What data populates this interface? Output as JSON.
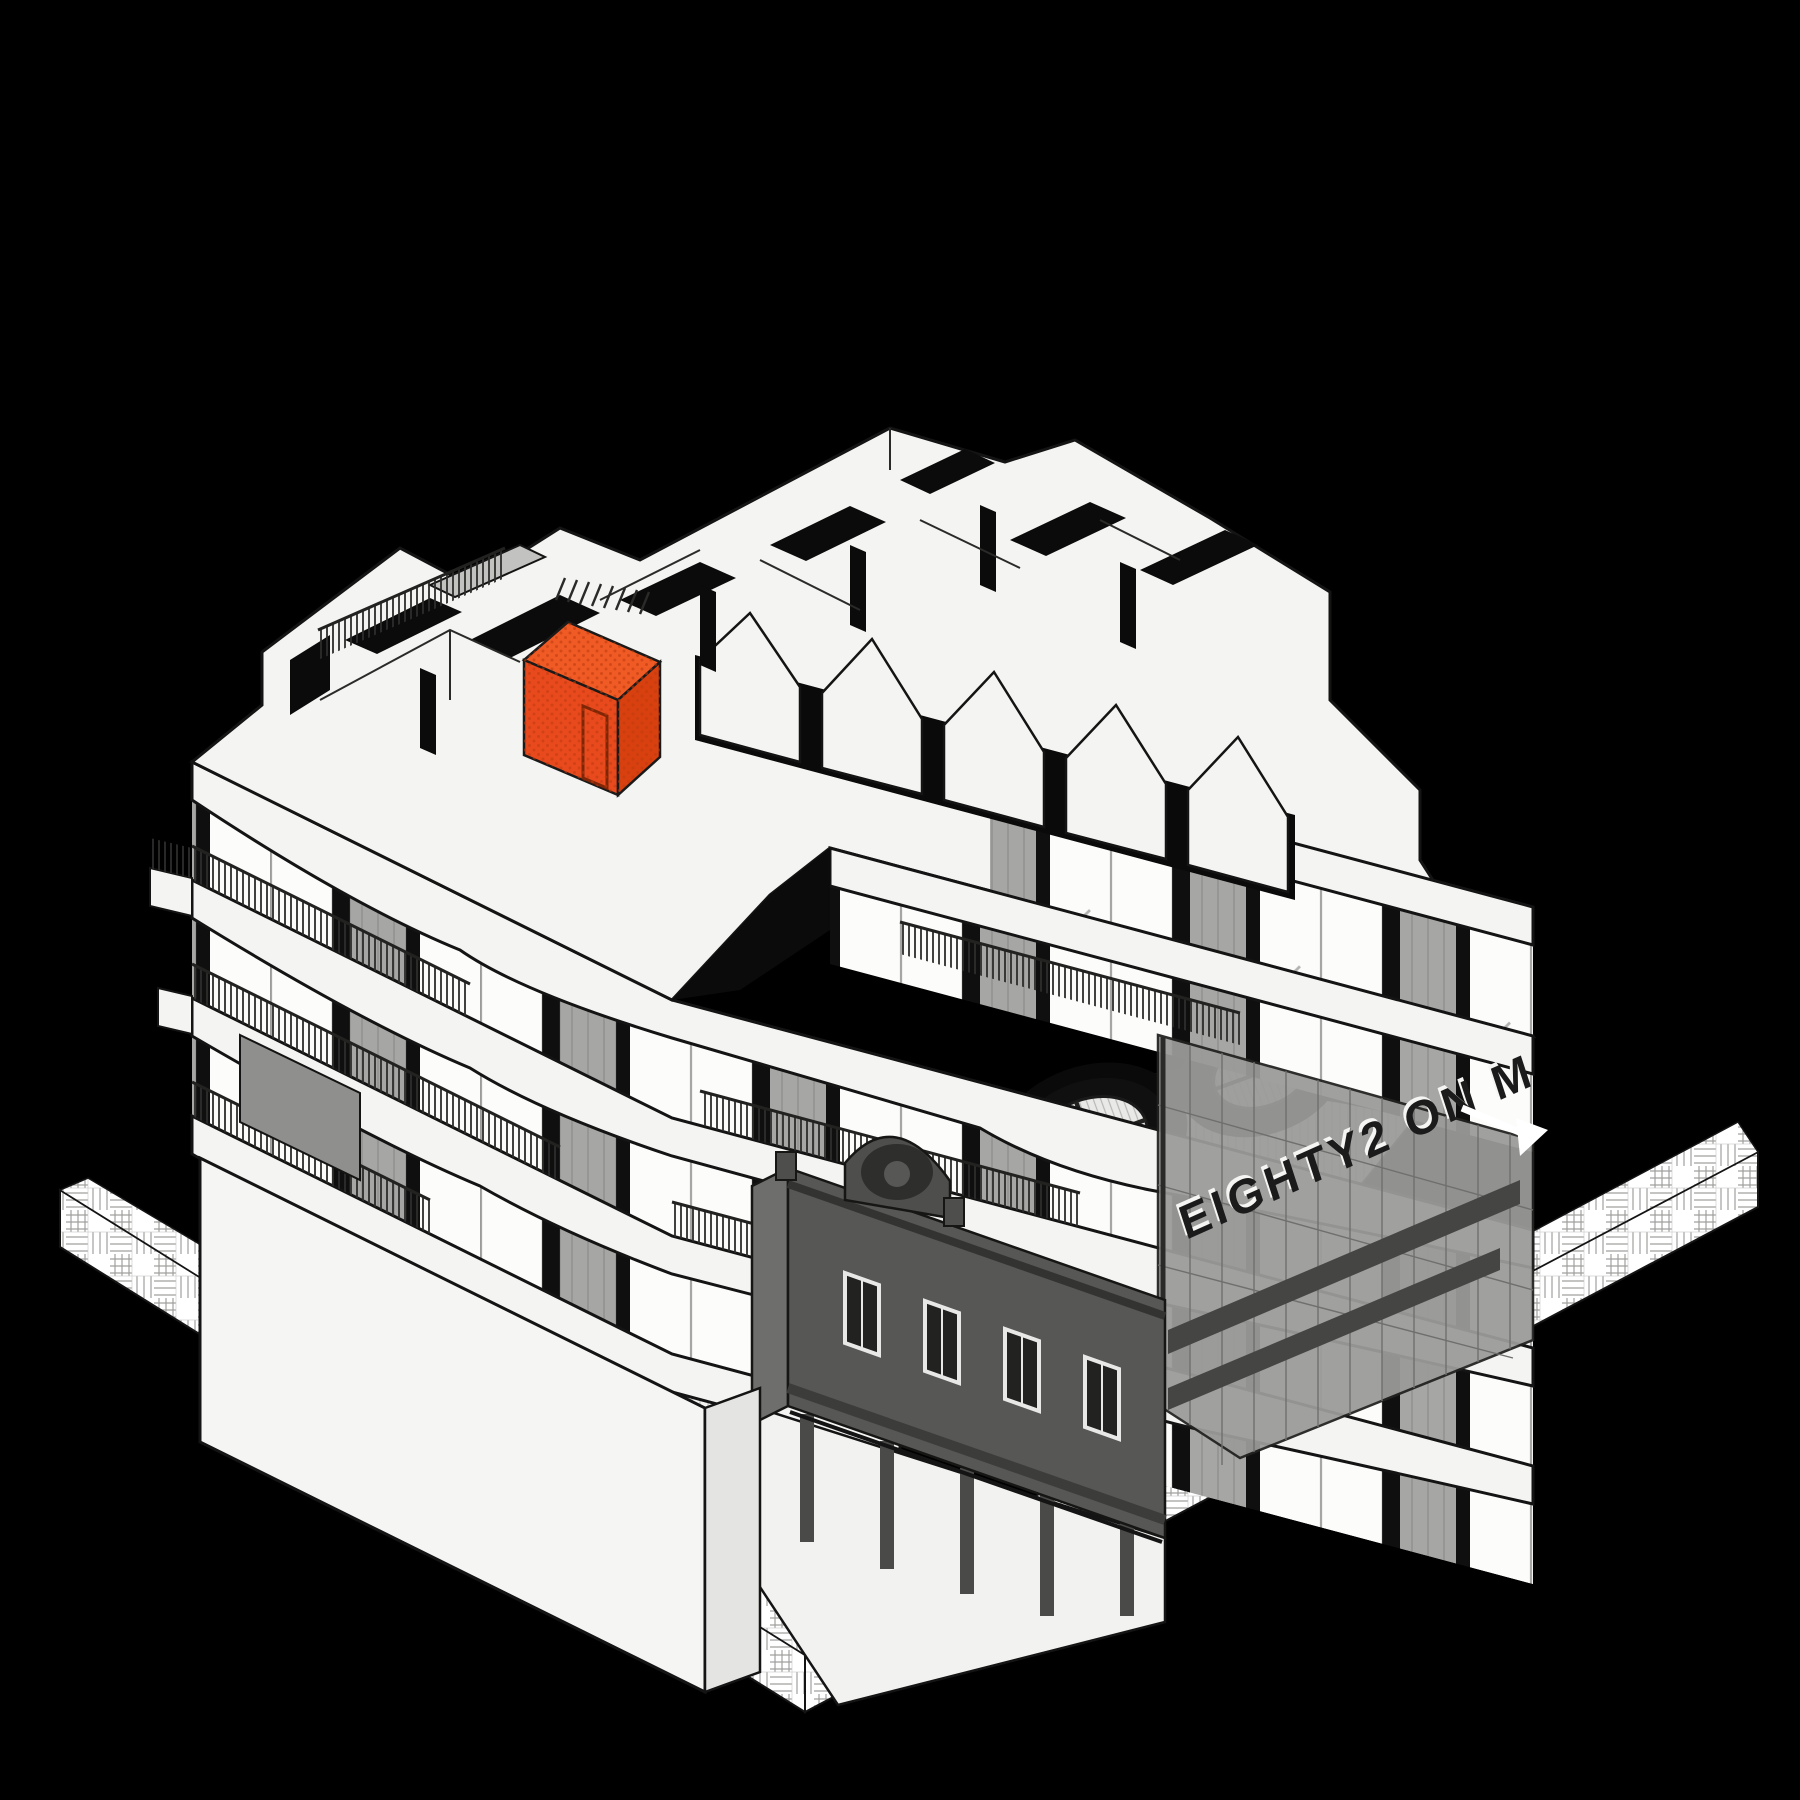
{
  "scene": {
    "background": "#000000",
    "description": "Axonometric cutaway rendering of apartment building with highlighted unit"
  },
  "sign": {
    "text": "EIGHTY2 ON M",
    "color": "#1b1b1b",
    "highlight_color": "#f5f5f3"
  },
  "highlight": {
    "label": "highlighted apartment",
    "color": "#E94A1D",
    "color_dark": "#D8400F",
    "color_light": "#F05A24",
    "dot": "#BC3A0E"
  },
  "palette": {
    "surface": "#f4f4f2",
    "glass": "#fcfcfb",
    "outline": "#141414",
    "mesh": "#a6a6a4",
    "heritage": "#575755",
    "heritage_dark": "#3d3d3b",
    "heritage_light": "#6e6e6c",
    "glass_volume": "#9b9b99",
    "stair_band": "#454543",
    "deck_stripe": "#c9c9c5",
    "paving_line": "#a0a09e",
    "railing": "#2c2c2a"
  }
}
